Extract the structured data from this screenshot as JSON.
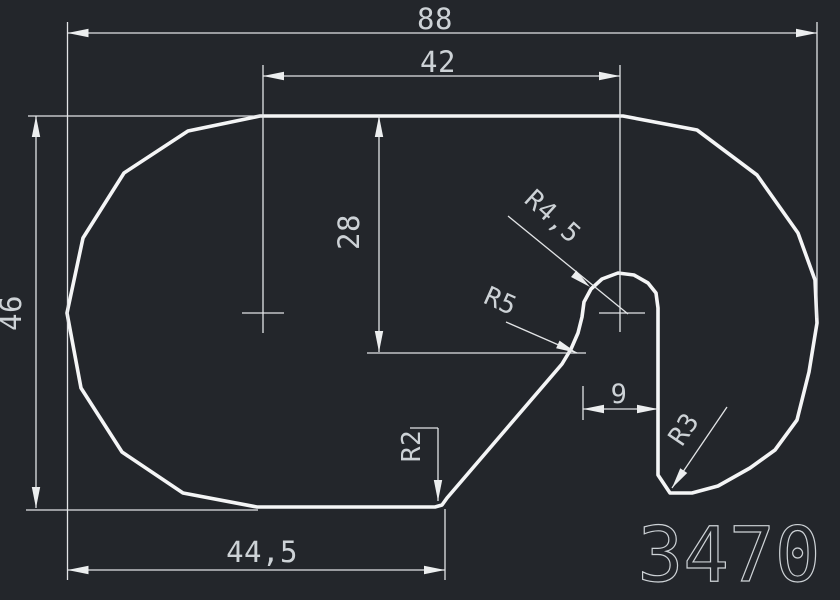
{
  "drawing": {
    "part_number": "3470",
    "dimensions": {
      "overall_width": "88",
      "top_width": "42",
      "overall_height": "46",
      "slot_depth": "28",
      "bottom_width": "44,5",
      "slot_width": "9",
      "knob_radius": "R4,5",
      "inner_radius": "R5",
      "notch_radius": "R3",
      "corner_radius": "R2"
    },
    "colors": {
      "background": "#23262b",
      "profile_outline": "#f4f5f6",
      "dimension_lines": "#e2e4e6",
      "dimension_text": "#cdd2d6"
    }
  }
}
